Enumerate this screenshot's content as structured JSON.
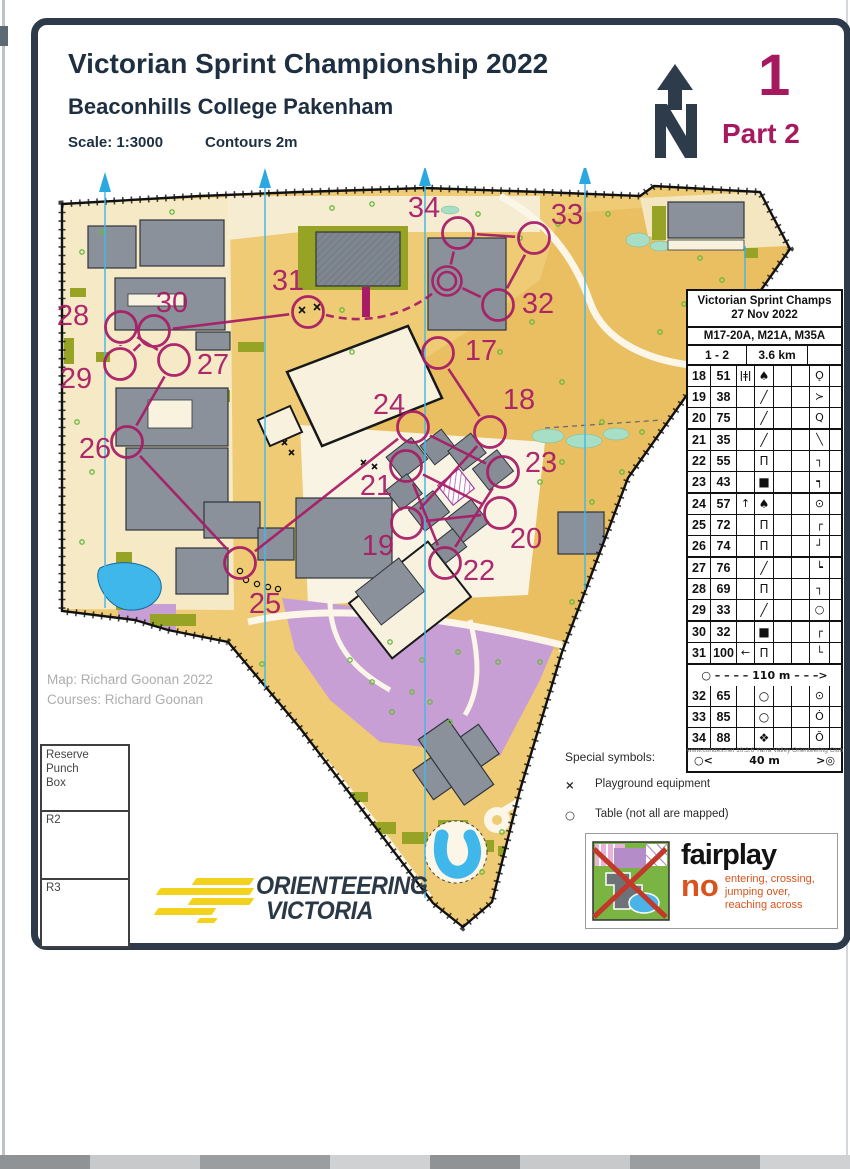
{
  "header": {
    "title": "Victorian Sprint Championship 2022",
    "subtitle": "Beaconhills College Pakenham",
    "scale": "Scale: 1:3000",
    "contours": "Contours 2m",
    "course_number": "1",
    "part": "Part 2"
  },
  "control_card": {
    "title_line1": "Victorian Sprint Champs",
    "title_line2": "27 Nov 2022",
    "classes": "M17-20A, M21A, M35A",
    "course": "1 - 2",
    "length": "3.6 km",
    "rows": [
      {
        "num": "18",
        "code": "51",
        "c": "ǀǂǀ",
        "d": "♠",
        "g": "Ǫ"
      },
      {
        "num": "19",
        "code": "38",
        "c": "",
        "d": "╱",
        "g": "≻"
      },
      {
        "num": "20",
        "code": "75",
        "c": "",
        "d": "╱",
        "g": "Q"
      },
      {
        "num": "21",
        "code": "35",
        "c": "",
        "d": "╱",
        "g": "╲"
      },
      {
        "num": "22",
        "code": "55",
        "c": "",
        "d": "Π",
        "g": "┐"
      },
      {
        "num": "23",
        "code": "43",
        "c": "",
        "d": "■",
        "g": "┑"
      },
      {
        "num": "24",
        "code": "57",
        "c": "↑",
        "d": "♠",
        "g": "⊙"
      },
      {
        "num": "25",
        "code": "72",
        "c": "",
        "d": "Π",
        "g": "┌"
      },
      {
        "num": "26",
        "code": "74",
        "c": "",
        "d": "Π",
        "g": "┘"
      },
      {
        "num": "27",
        "code": "76",
        "c": "",
        "d": "╱",
        "g": "┕"
      },
      {
        "num": "28",
        "code": "69",
        "c": "",
        "d": "Π",
        "g": "┐"
      },
      {
        "num": "29",
        "code": "33",
        "c": "",
        "d": "╱",
        "g": "○"
      },
      {
        "num": "30",
        "code": "32",
        "c": "",
        "d": "■",
        "g": "┌"
      },
      {
        "num": "31",
        "code": "100",
        "c": "←",
        "d": "Π",
        "g": "└"
      }
    ],
    "exchange": {
      "left": "○",
      "pre": "– – – –",
      "label": "110 m",
      "post": "– – –>"
    },
    "rows2": [
      {
        "num": "32",
        "code": "65",
        "c": "",
        "d": "○",
        "g": "⊙"
      },
      {
        "num": "33",
        "code": "85",
        "c": "",
        "d": "○",
        "g": "Ȯ"
      },
      {
        "num": "34",
        "code": "88",
        "c": "",
        "d": "❖",
        "g": "Ŏ"
      }
    ],
    "finish": {
      "left": "○<",
      "label": "40 m",
      "right": ">◎"
    },
    "footer": "www.condes.net 10.3.6 Yarra Valley Orienteering Club"
  },
  "special_symbols": {
    "heading": "Special symbols:",
    "items": [
      {
        "symbol": "×",
        "label": "Playground equipment"
      },
      {
        "symbol": "○",
        "label": "Table (not all are mapped)"
      }
    ]
  },
  "fairplay": {
    "title": "fairplay",
    "no_word": "no",
    "lines": [
      "entering, crossing,",
      "jumping over,",
      "reaching across"
    ]
  },
  "reserve_box": {
    "title_lines": [
      "Reserve",
      "Punch",
      "Box"
    ],
    "cells": [
      "R2",
      "R3"
    ]
  },
  "credits": {
    "line1": "Map: Richard Goonan 2022",
    "line2": "Courses: Richard Goonan"
  },
  "logo": {
    "line1": "ORIENTEERING",
    "line2": "VICTORIA"
  },
  "map_course": {
    "color": "#a81b66",
    "circle_radius": 15.5,
    "label_font_size": 29,
    "controls": [
      {
        "num": "17",
        "x": 438,
        "y": 353,
        "lx": 481,
        "ly": 360
      },
      {
        "num": "18",
        "x": 490,
        "y": 432,
        "lx": 519,
        "ly": 409
      },
      {
        "num": "19",
        "x": 407,
        "y": 523,
        "lx": 378,
        "ly": 555
      },
      {
        "num": "20",
        "x": 500,
        "y": 513,
        "lx": 526,
        "ly": 548
      },
      {
        "num": "21",
        "x": 406,
        "y": 466,
        "lx": 376,
        "ly": 495
      },
      {
        "num": "22",
        "x": 445,
        "y": 563,
        "lx": 479,
        "ly": 580
      },
      {
        "num": "23",
        "x": 503,
        "y": 472,
        "lx": 541,
        "ly": 472
      },
      {
        "num": "24",
        "x": 413,
        "y": 427,
        "lx": 389,
        "ly": 414
      },
      {
        "num": "25",
        "x": 240,
        "y": 563,
        "lx": 265,
        "ly": 613
      },
      {
        "num": "26",
        "x": 127,
        "y": 442,
        "lx": 95,
        "ly": 458
      },
      {
        "num": "27",
        "x": 174,
        "y": 360,
        "lx": 213,
        "ly": 374
      },
      {
        "num": "28",
        "x": 121,
        "y": 327,
        "lx": 73,
        "ly": 325
      },
      {
        "num": "29",
        "x": 120,
        "y": 364,
        "lx": 76,
        "ly": 388
      },
      {
        "num": "30",
        "x": 154,
        "y": 331,
        "lx": 172,
        "ly": 312
      },
      {
        "num": "31",
        "x": 308,
        "y": 312,
        "lx": 288,
        "ly": 290
      },
      {
        "num": "32",
        "x": 498,
        "y": 305,
        "lx": 538,
        "ly": 313
      },
      {
        "num": "33",
        "x": 534,
        "y": 238,
        "lx": 567,
        "ly": 224
      },
      {
        "num": "34",
        "x": 458,
        "y": 233,
        "lx": 424,
        "ly": 217
      }
    ],
    "finish": {
      "x": 447,
      "y": 281
    },
    "legs": [
      [
        "17",
        "18"
      ],
      [
        "18",
        "19"
      ],
      [
        "19",
        "20"
      ],
      [
        "20",
        "21"
      ],
      [
        "21",
        "22"
      ],
      [
        "22",
        "23"
      ],
      [
        "23",
        "24"
      ],
      [
        "24",
        "25"
      ],
      [
        "25",
        "26"
      ],
      [
        "26",
        "27"
      ],
      [
        "27",
        "28"
      ],
      [
        "28",
        "29"
      ],
      [
        "29",
        "30"
      ],
      [
        "30",
        "31"
      ],
      [
        "F",
        "32"
      ],
      [
        "32",
        "33"
      ],
      [
        "33",
        "34"
      ],
      [
        "34",
        "F"
      ]
    ],
    "marked_route_path": "M326,315 C365,325 404,316 433,293"
  }
}
